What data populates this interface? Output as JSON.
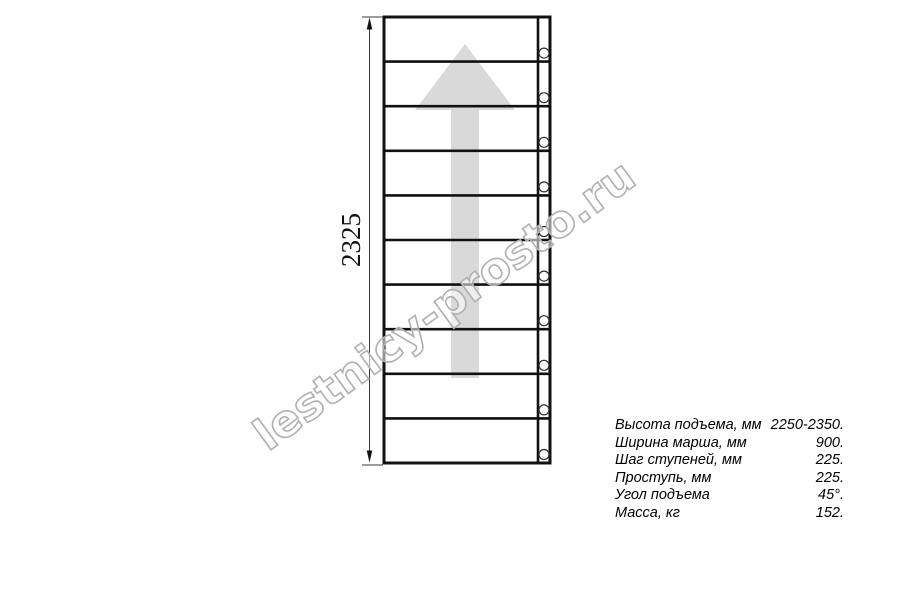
{
  "drawing": {
    "type": "staircase-plan-top-view",
    "steps_count": 10,
    "height_dimension": "2325",
    "watermark": "lestnicy-prosto.ru"
  },
  "specs": {
    "rows": [
      {
        "label": "Высота подъема, мм",
        "value": "2250-2350."
      },
      {
        "label": "Ширина марша, мм",
        "value": "900."
      },
      {
        "label": "Шаг ступеней, мм",
        "value": "225."
      },
      {
        "label": "Проступь, мм",
        "value": "225."
      },
      {
        "label": "Угол подъема",
        "value": "45°."
      },
      {
        "label": "Масса, кг",
        "value": "152."
      }
    ]
  },
  "colors": {
    "line": "#111111",
    "thin_line": "#3a3a3a",
    "circle_stroke": "#333333",
    "arrow_fill": "#d9d9d9",
    "watermark_stroke": "#b1b1b1",
    "background": "#ffffff"
  }
}
